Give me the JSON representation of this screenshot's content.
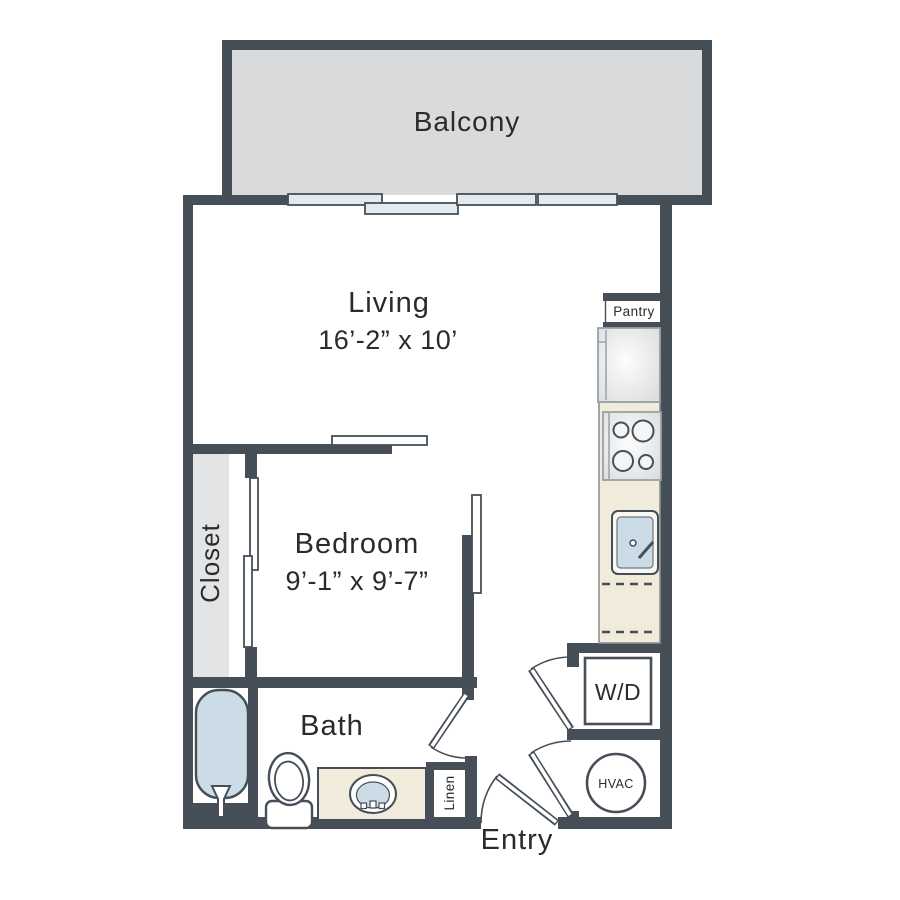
{
  "colors": {
    "wall": "#464e58",
    "balcony-fill": "#d8dadc",
    "closet-fill": "#e3e4e6",
    "counter-fill": "#f0ebdb",
    "water-fill": "#ccdce6",
    "panel-fill": "#e4ebf0",
    "appliance-stroke": "#9aa0a6",
    "text": "#2b2b2b"
  },
  "rooms": {
    "balcony": {
      "label": "Balcony"
    },
    "living": {
      "label": "Living",
      "dimensions": "16’-2” x 10’"
    },
    "bedroom": {
      "label": "Bedroom",
      "dimensions": "9’-1” x 9’-7”"
    },
    "closet": {
      "label": "Closet"
    },
    "bath": {
      "label": "Bath"
    },
    "entry": {
      "label": "Entry"
    }
  },
  "features": {
    "pantry": {
      "label": "Pantry"
    },
    "linen": {
      "label": "Linen"
    },
    "washer_dryer": {
      "label": "W/D"
    },
    "hvac": {
      "label": "HVAC"
    }
  }
}
